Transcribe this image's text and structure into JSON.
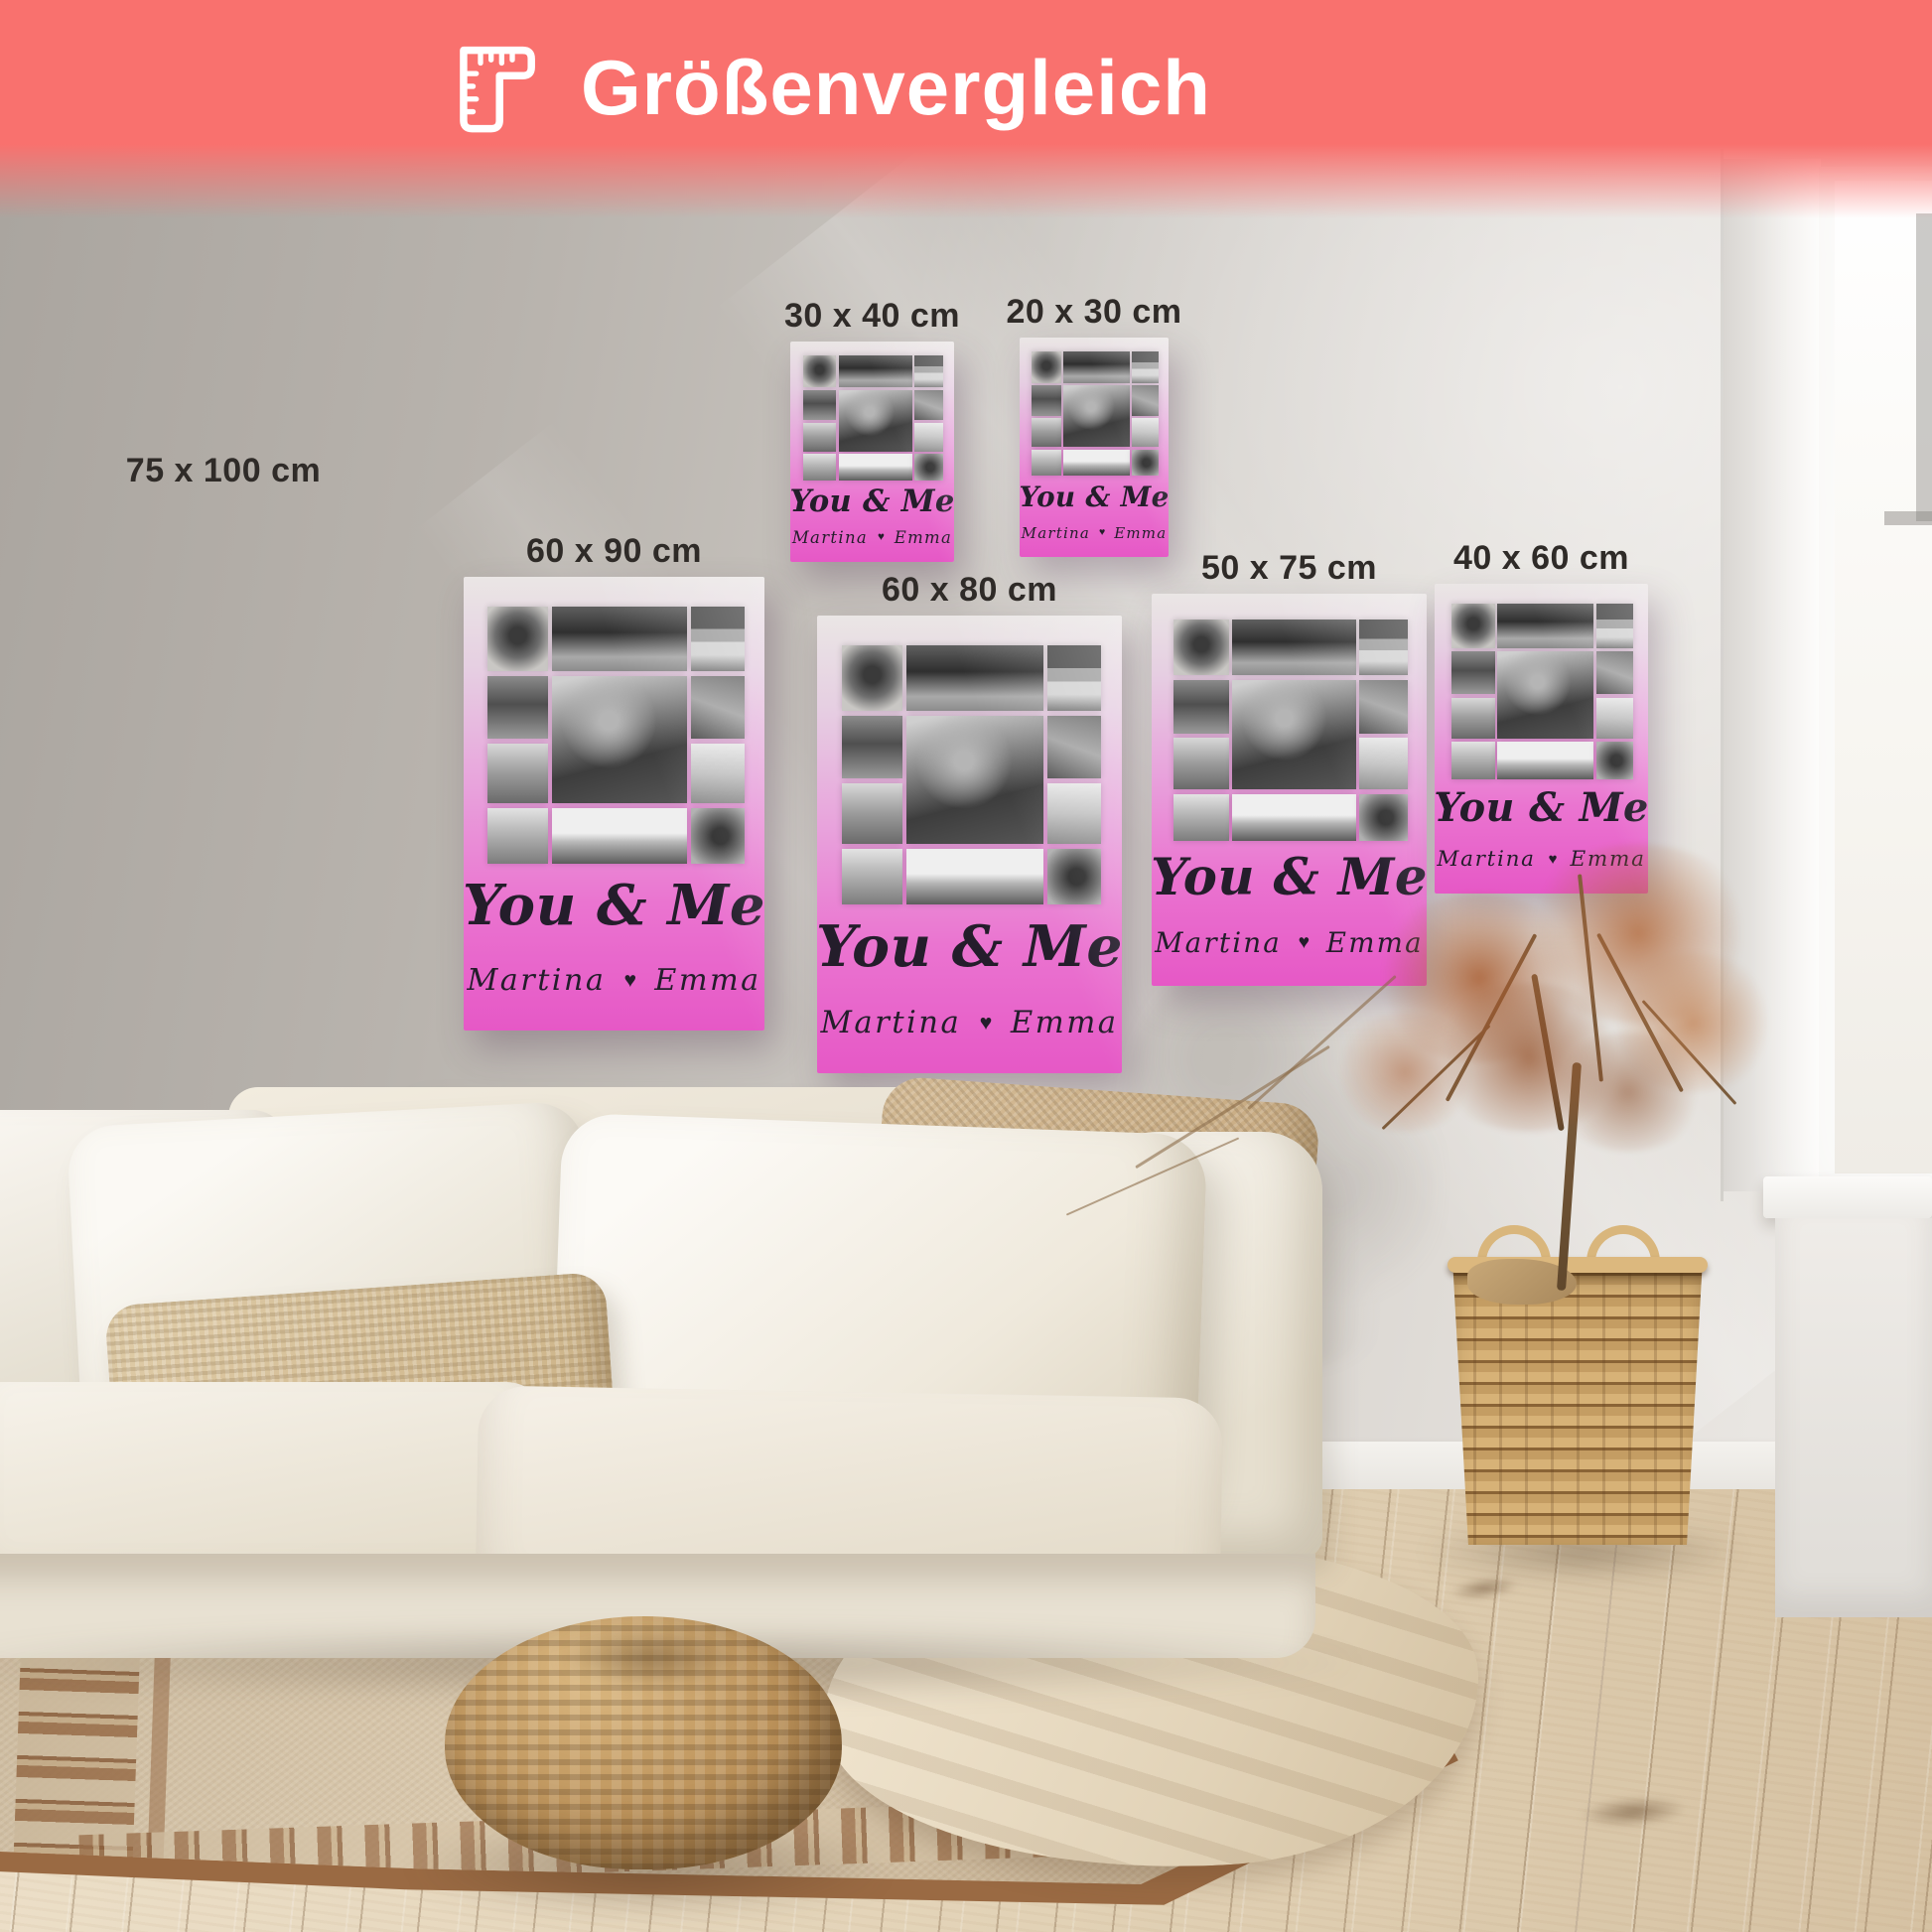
{
  "banner": {
    "title": "Größenvergleich",
    "icon": "corner-ruler-icon",
    "bg_color": "#f9716e",
    "text_color": "#ffffff"
  },
  "poster_design": {
    "title": "You & Me",
    "name_left": "Martina",
    "name_right": "Emma",
    "heart": "♥",
    "sparkle": "✦",
    "pink_accent": "#e658c6"
  },
  "posters": [
    {
      "id": "75x100",
      "label": "75 x 100 cm",
      "poster_visible": false
    },
    {
      "id": "30x40",
      "label": "30 x 40 cm",
      "poster_visible": true
    },
    {
      "id": "20x30",
      "label": "20 x 30 cm",
      "poster_visible": true
    },
    {
      "id": "60x90",
      "label": "60 x 90 cm",
      "poster_visible": true
    },
    {
      "id": "60x80",
      "label": "60 x 80 cm",
      "poster_visible": true
    },
    {
      "id": "50x75",
      "label": "50 x 75 cm",
      "poster_visible": true
    },
    {
      "id": "40x60",
      "label": "40 x 60 cm",
      "poster_visible": true
    }
  ]
}
